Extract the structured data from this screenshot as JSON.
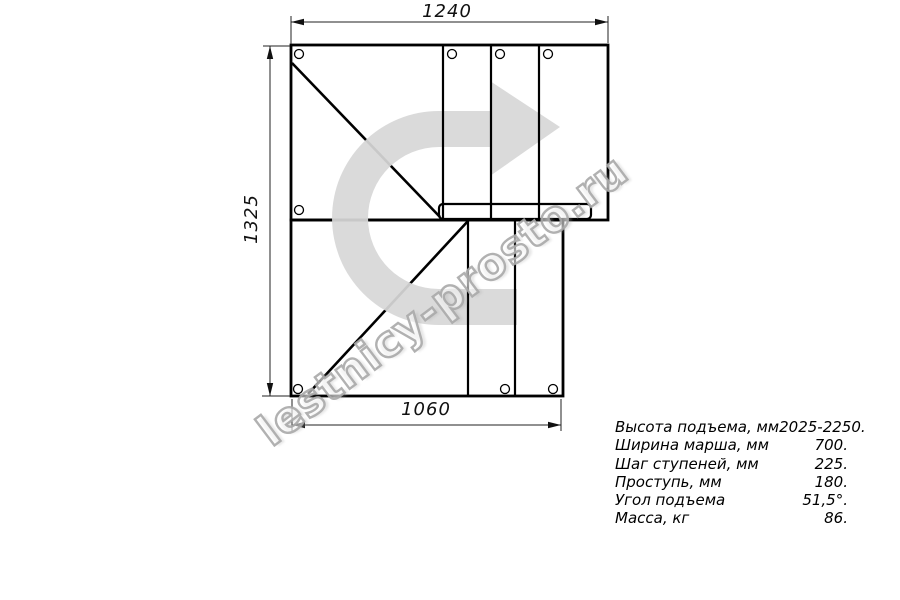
{
  "drawing": {
    "title": "staircase-plan-view",
    "dimensions": {
      "top": "1240",
      "left": "1325",
      "bottom": "1060"
    }
  },
  "watermark": {
    "text": "lestnicy-prosto.ru"
  },
  "specs": {
    "rows": [
      {
        "label": "Высота подъема, мм",
        "value": "2025-2250."
      },
      {
        "label": "Ширина марша, мм",
        "value": "700."
      },
      {
        "label": "Шаг ступеней, мм",
        "value": "225."
      },
      {
        "label": "Проступь, мм",
        "value": "180."
      },
      {
        "label": "Угол подъема",
        "value": "51,5°."
      },
      {
        "label": "Масса, кг",
        "value": "86."
      }
    ]
  },
  "colors": {
    "line": "#000000",
    "arrow_fill": "rgba(215,215,215,0.93)",
    "watermark_outline": "#a8a8a8",
    "background": "#ffffff"
  },
  "icons": {
    "direction_arrow": "u-turn-right-arrow-icon"
  }
}
